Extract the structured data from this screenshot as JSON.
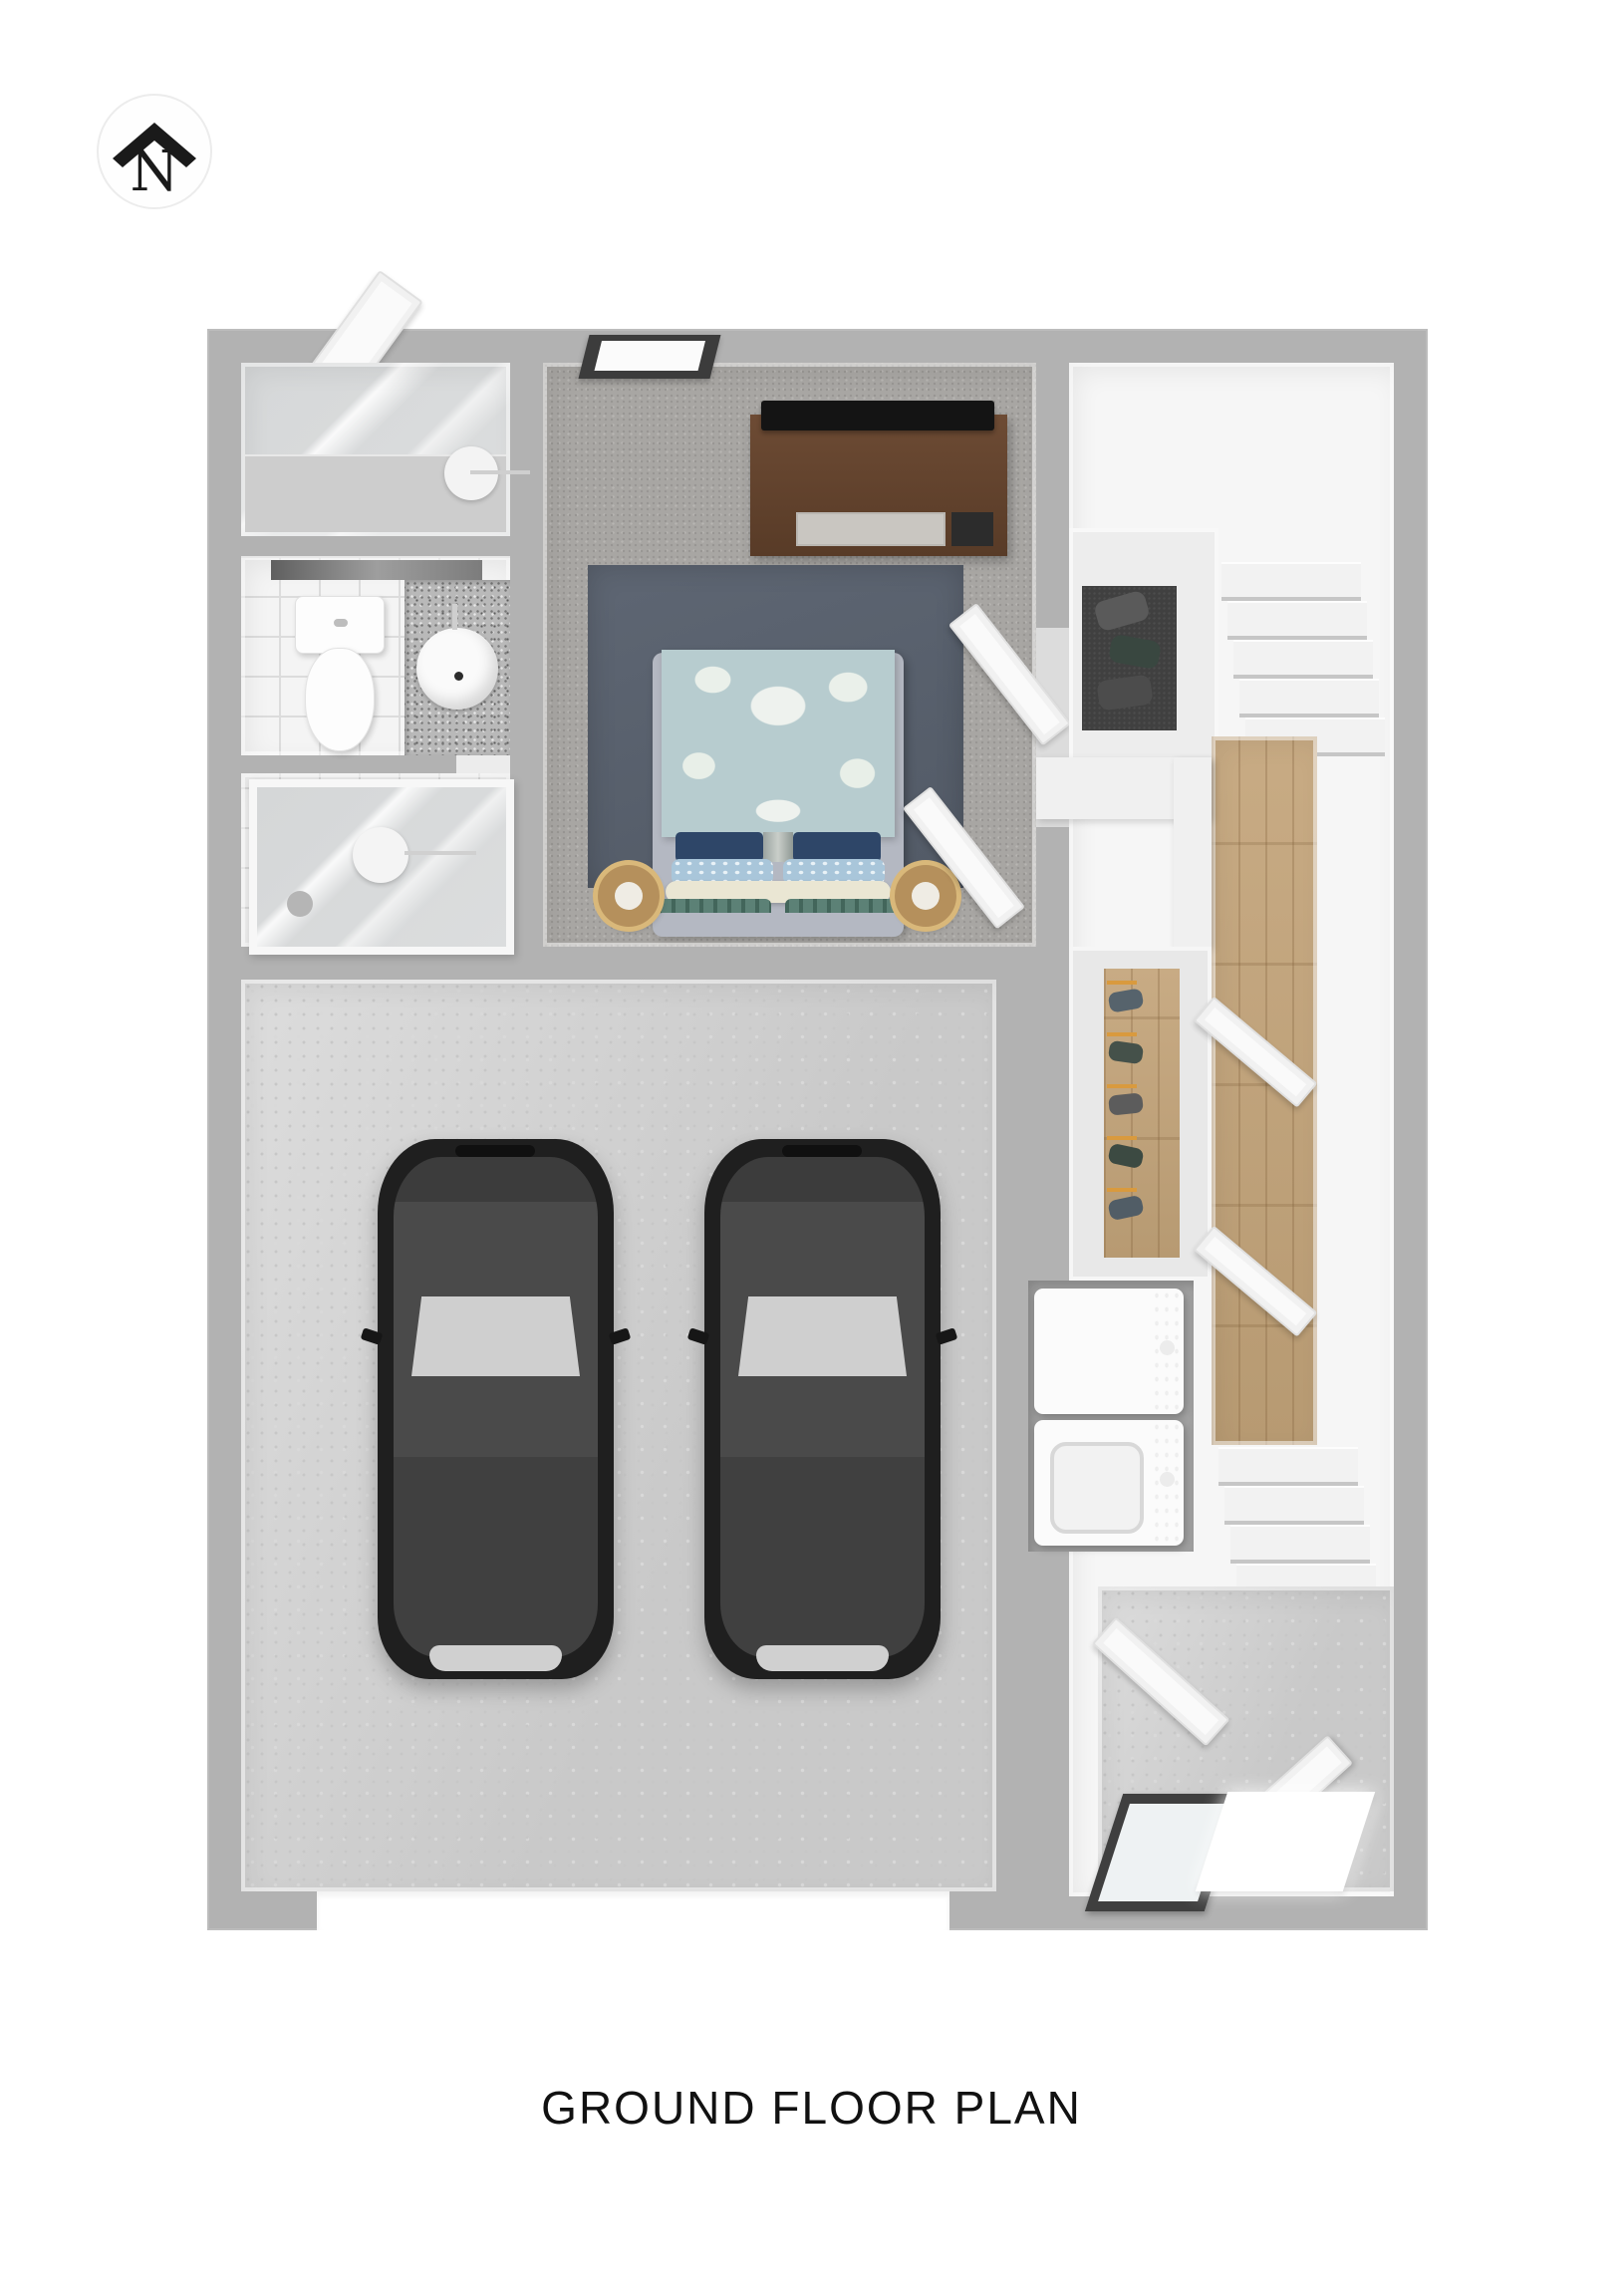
{
  "north": {
    "label": "N"
  },
  "footer": {
    "title": "GROUND FLOOR PLAN"
  },
  "palette": {
    "wall_gray": "#b2b2b2",
    "interior_white": "#f6f6f6",
    "bedroom_carpet": "#a8a6a3",
    "area_rug_navy": "#59606d",
    "duvet_blue": "#b7cccf",
    "pillow_navy": "#2e4668",
    "pillow_teal": "#5c8176",
    "wood_floor": "#c2a47e",
    "concrete_floor": "#d1d1d1",
    "closet_carpet_dark": "#404040",
    "car_black": "#1f1f1f",
    "tv_console_wood": "#6d4b34",
    "appliance_panel_gray": "#5c5c5c"
  }
}
